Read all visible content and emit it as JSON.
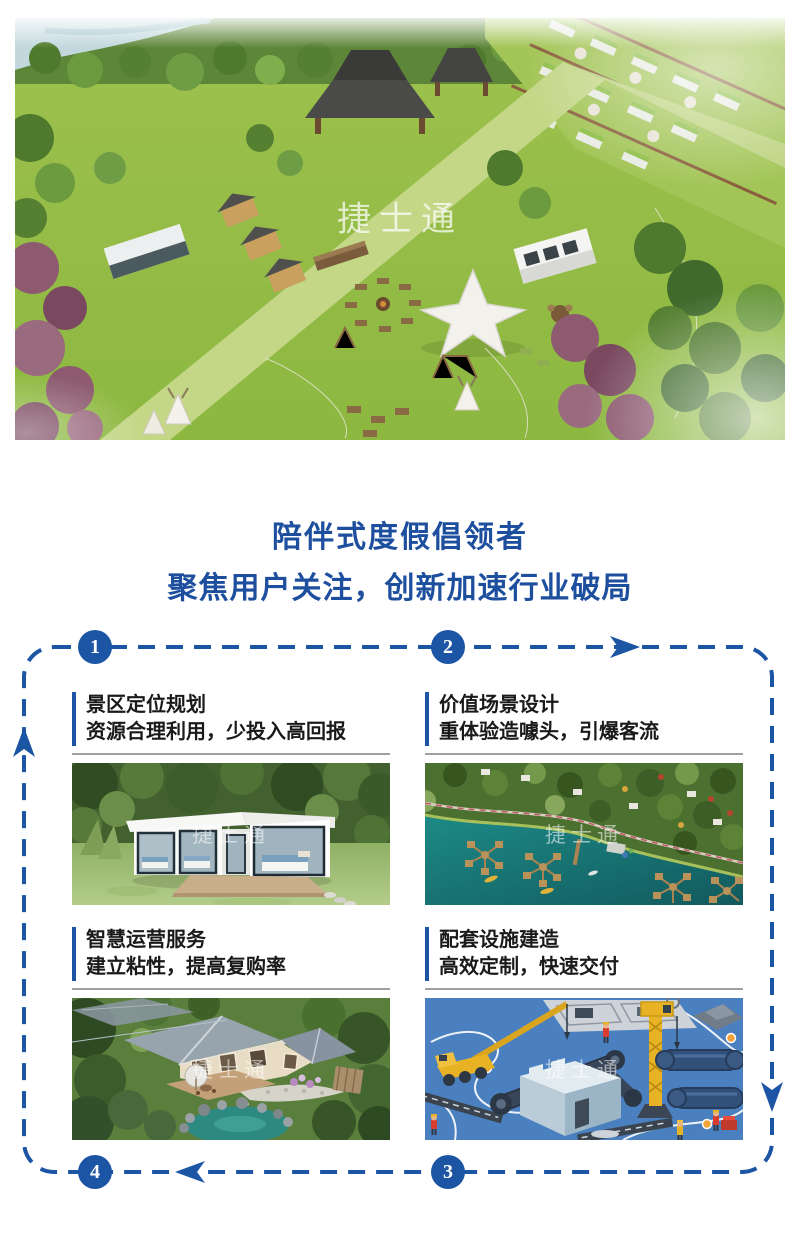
{
  "colors": {
    "accent_blue": "#1d55a5",
    "headline_blue": "#1d4f9e",
    "title_dark": "#1a1a1a",
    "divider_gray": "#a0a0a0"
  },
  "hero": {
    "watermark": "捷士通",
    "image_alt": "camp-resort-aerial-render"
  },
  "headline": {
    "line1": "陪伴式度假倡领者",
    "line2": "聚焦用户关注，创新加速行业破局"
  },
  "flow": {
    "steps": [
      {
        "number": "1"
      },
      {
        "number": "2"
      },
      {
        "number": "3"
      },
      {
        "number": "4"
      }
    ],
    "blocks": [
      {
        "title": "景区定位规划",
        "subtitle": "资源合理利用，少投入高回报",
        "watermark": "捷士通",
        "image_alt": "modern-cabin-render"
      },
      {
        "title": "价值场景设计",
        "subtitle": "重体验造噱头，引爆客流",
        "watermark": "捷士通",
        "image_alt": "lakeside-aerial-render"
      },
      {
        "title": "智慧运营服务",
        "subtitle": "建立粘性，提高复购率",
        "watermark": "捷士通",
        "image_alt": "garden-homestay-render"
      },
      {
        "title": "配套设施建造",
        "subtitle": "高效定制，快速交付",
        "watermark": "捷士通",
        "image_alt": "construction-illustration"
      }
    ]
  }
}
